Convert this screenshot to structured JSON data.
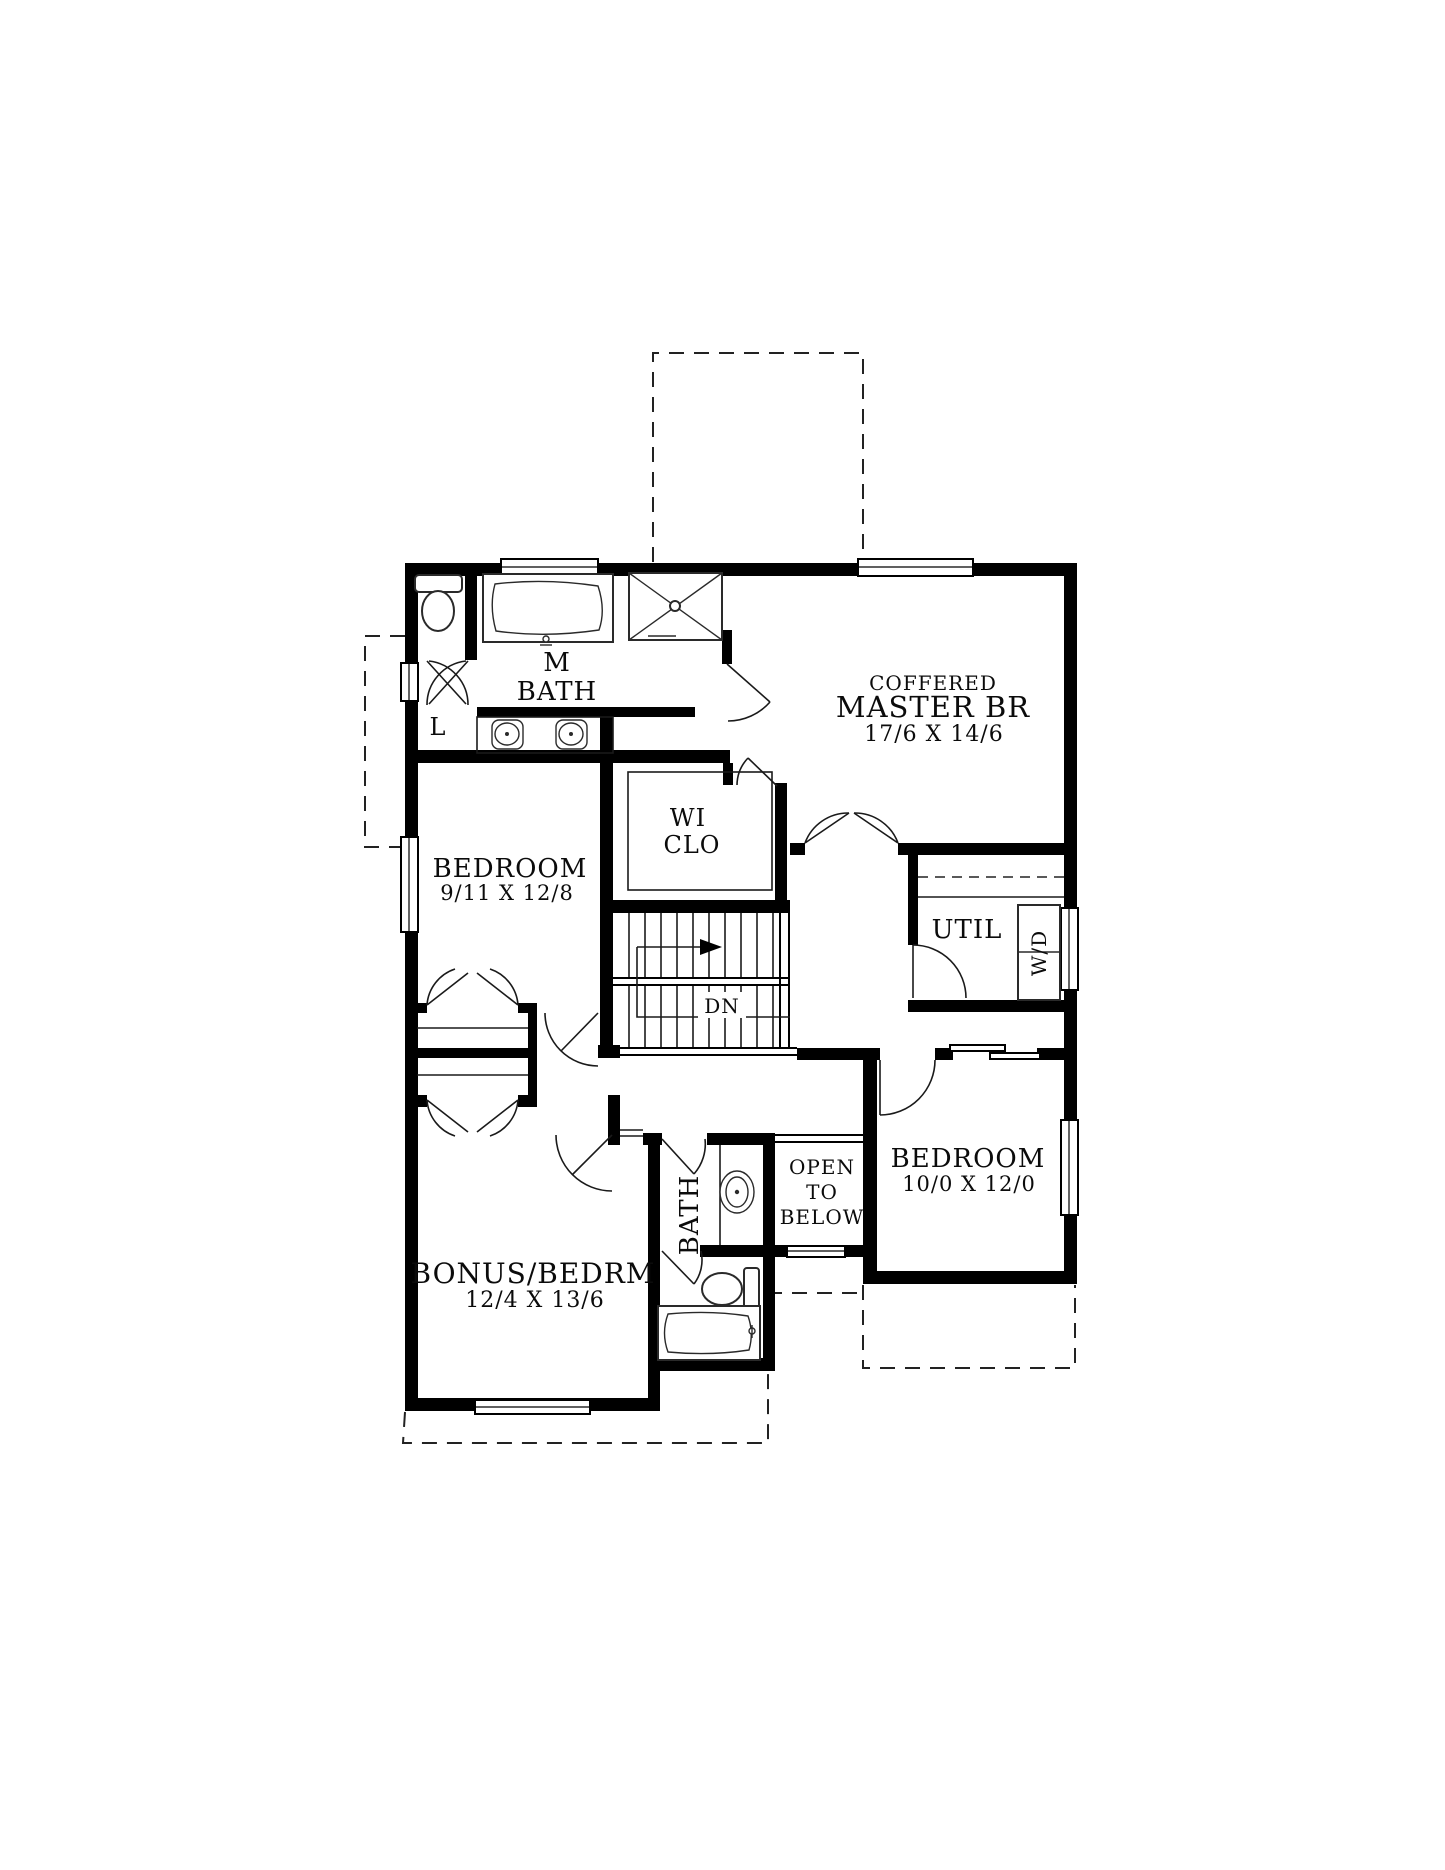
{
  "plan": {
    "type": "second-floor-plan",
    "colors": {
      "wall": "#000000",
      "background": "#ffffff",
      "line": "#1a1a1a"
    },
    "rooms": {
      "master": {
        "tag": "COFFERED",
        "name": "MASTER BR",
        "dims": "17/6 X 14/6"
      },
      "mbath": {
        "line1": "M",
        "line2": "BATH"
      },
      "wiclo": {
        "line1": "WI",
        "line2": "CLO"
      },
      "bedroom1": {
        "name": "BEDROOM",
        "dims": "9/11 X 12/8"
      },
      "util": {
        "name": "UTIL",
        "appliance": "W/D"
      },
      "bedroom2": {
        "name": "BEDROOM",
        "dims": "10/0 X 12/0"
      },
      "bonus": {
        "name": "BONUS/BEDRM",
        "dims": "12/4 X 13/6"
      },
      "bath": {
        "name": "BATH"
      },
      "open_below": {
        "line1": "OPEN",
        "line2": "TO",
        "line3": "BELOW"
      },
      "linen": {
        "name": "L"
      },
      "stairs": {
        "label": "DN"
      }
    }
  }
}
